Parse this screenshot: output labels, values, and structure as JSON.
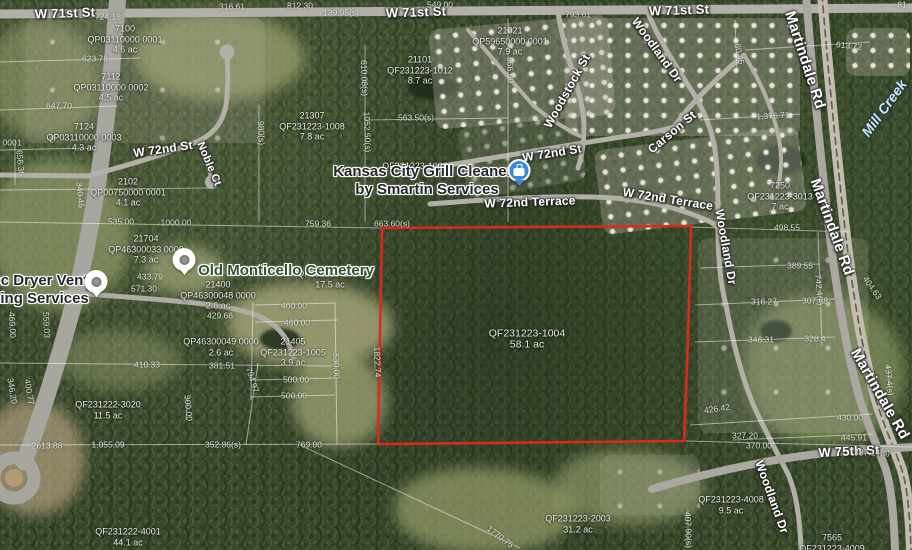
{
  "selected_parcel": {
    "id": "QF231223-1004",
    "area": "58.1 ac",
    "outline_color": "#dd2a1b"
  },
  "streets": [
    {
      "text": "W 71st St",
      "x": 65,
      "y": 13,
      "rot": -2,
      "size": 13
    },
    {
      "text": "W 71st St",
      "x": 416,
      "y": 12,
      "rot": -2,
      "size": 13
    },
    {
      "text": "W 71st St",
      "x": 679,
      "y": 10,
      "rot": -2,
      "size": 13
    },
    {
      "text": "W 72nd St",
      "x": 163,
      "y": 149,
      "rot": -8,
      "size": 12
    },
    {
      "text": "W 72nd St",
      "x": 552,
      "y": 153,
      "rot": -9,
      "size": 12
    },
    {
      "text": "W 72nd Terrace",
      "x": 530,
      "y": 202,
      "rot": -2,
      "size": 12
    },
    {
      "text": "W 72nd Terrace",
      "x": 668,
      "y": 199,
      "rot": 9,
      "size": 12
    },
    {
      "text": "Noble Ct",
      "x": 209,
      "y": 164,
      "rot": 67,
      "size": 11
    },
    {
      "text": "Woodstock St",
      "x": 567,
      "y": 91,
      "rot": -61,
      "size": 12
    },
    {
      "text": "Carson St",
      "x": 672,
      "y": 132,
      "rot": -40,
      "size": 12
    },
    {
      "text": "Woodland Dr",
      "x": 657,
      "y": 50,
      "rot": 54,
      "size": 12
    },
    {
      "text": "Woodland Dr",
      "x": 726,
      "y": 247,
      "rot": 80,
      "size": 12
    },
    {
      "text": "Woodland Dr",
      "x": 772,
      "y": 497,
      "rot": 70,
      "size": 12
    },
    {
      "text": "Martindale Rd",
      "x": 805,
      "y": 60,
      "rot": 72,
      "size": 15
    },
    {
      "text": "Martindale Rd",
      "x": 832,
      "y": 227,
      "rot": 70,
      "size": 15
    },
    {
      "text": "Martindale Rd",
      "x": 880,
      "y": 394,
      "rot": 60,
      "size": 15
    },
    {
      "text": "W 75th St",
      "x": 849,
      "y": 451,
      "rot": -3,
      "size": 13
    }
  ],
  "water_labels": [
    {
      "text": "Mill Creek",
      "x": 884,
      "y": 108,
      "rot": -54,
      "size": 14
    }
  ],
  "pois": [
    {
      "name": "kansas-city-grill-cleaners",
      "lines": [
        "Kansas City Grill Cleaners",
        "by Smartin Services"
      ],
      "x": 427,
      "y": 181,
      "color": "#23282d",
      "pin": "business",
      "icon": "briefcase-icon",
      "pin_x": 519,
      "pin_y": 175
    },
    {
      "name": "old-monticello-cemetery",
      "lines": [
        "Old Monticello Cemetery"
      ],
      "x": 286,
      "y": 271,
      "color": "#2f5233",
      "pin": "generic",
      "icon": "cemetery-icon",
      "pin_x": 184,
      "pin_y": 264
    },
    {
      "name": "dryer-vent-cleaning-services",
      "lines": [
        "oc Dryer Vent",
        "ning Services"
      ],
      "x": 40,
      "y": 290,
      "color": "#23282d",
      "pin": "generic",
      "icon": "services-icon",
      "pin_x": 96,
      "pin_y": 286
    }
  ],
  "parcel_labels": [
    {
      "lines": [
        "7100",
        "QP03110000 0001",
        "4.6 ac"
      ],
      "x": 125,
      "y": 39
    },
    {
      "lines": [
        "7112",
        "QP03110000 0002",
        "4.5 ac"
      ],
      "x": 111,
      "y": 87
    },
    {
      "lines": [
        "7124",
        "QP03110000 0003",
        "4.3 ac"
      ],
      "x": 84,
      "y": 137
    },
    {
      "lines": [
        "21021",
        "QP59650000 0001",
        "7.9 ac"
      ],
      "x": 510,
      "y": 41
    },
    {
      "lines": [
        "21101",
        "QF231223-1012",
        "8.7 ac"
      ],
      "x": 420,
      "y": 70
    },
    {
      "lines": [
        "21307",
        "QF231223-1008",
        "7.8 ac"
      ],
      "x": 312,
      "y": 126
    },
    {
      "lines": [
        "QF231223-1003"
      ],
      "x": 415,
      "y": 166
    },
    {
      "lines": [
        "2102",
        "QP00750000 0001",
        "4.1 ac"
      ],
      "x": 128,
      "y": 192
    },
    {
      "lines": [
        "21704",
        "QP46300033 0000",
        "7.3 ac"
      ],
      "x": 146,
      "y": 249
    },
    {
      "lines": [
        "21400",
        "QP46300048 0000",
        "2.6 ac"
      ],
      "x": 218,
      "y": 295
    },
    {
      "lines": [
        "QP46300049 0000",
        "2.6 ac"
      ],
      "x": 221,
      "y": 347
    },
    {
      "lines": [
        "21405",
        "QF231223-1005",
        "3.9 ac"
      ],
      "x": 293,
      "y": 352
    },
    {
      "lines": [
        "QF231223-1017",
        "17.5 ac"
      ],
      "x": 330,
      "y": 279
    },
    {
      "lines": [
        "QF231223-1004",
        "58.1 ac"
      ],
      "x": 527,
      "y": 339,
      "size": 10.5
    },
    {
      "lines": [
        "7250",
        "QF231223-3013",
        "7 ac"
      ],
      "x": 780,
      "y": 196
    },
    {
      "lines": [
        "QF231222-3020",
        "11.5 ac"
      ],
      "x": 108,
      "y": 410
    },
    {
      "lines": [
        "QF231222-4001",
        "44.1 ac"
      ],
      "x": 128,
      "y": 537
    },
    {
      "lines": [
        "QF231223-2003",
        "31.2 ac"
      ],
      "x": 578,
      "y": 524
    },
    {
      "lines": [
        "QF231223-4008",
        "9.5 ac"
      ],
      "x": 731,
      "y": 505
    },
    {
      "lines": [
        "7565",
        "QF231223-4009"
      ],
      "x": 832,
      "y": 543
    }
  ],
  "measurements": [
    {
      "t": "724.18",
      "x": 108,
      "y": 17
    },
    {
      "t": "316.61",
      "x": 232,
      "y": 7
    },
    {
      "t": "812.30",
      "x": 300,
      "y": 6
    },
    {
      "t": "139.95(s)",
      "x": 341,
      "y": 13
    },
    {
      "t": "549.00",
      "x": 440,
      "y": 5
    },
    {
      "t": "793.61",
      "x": 578,
      "y": 15
    },
    {
      "t": "81",
      "x": 902,
      "y": 5
    },
    {
      "t": "623.78",
      "x": 95,
      "y": 59
    },
    {
      "t": "647.70",
      "x": 59,
      "y": 106
    },
    {
      "t": "656.36",
      "x": 20,
      "y": 163,
      "rot": 85
    },
    {
      "t": "0001",
      "x": 12,
      "y": 143
    },
    {
      "t": "980(s)",
      "x": 261,
      "y": 133,
      "rot": 87
    },
    {
      "t": "610.08(s)",
      "x": 364,
      "y": 78,
      "rot": 88
    },
    {
      "t": "1052.50(s)",
      "x": 367,
      "y": 132,
      "rot": 88
    },
    {
      "t": "666.60",
      "x": 510,
      "y": 70,
      "rot": 88
    },
    {
      "t": "563.50(s)",
      "x": 416,
      "y": 118
    },
    {
      "t": "80.45",
      "x": 739,
      "y": 54,
      "rot": 78
    },
    {
      "t": "613.72",
      "x": 849,
      "y": 46,
      "rot": 6
    },
    {
      "t": "1,376.71",
      "x": 773,
      "y": 116,
      "rot": -3
    },
    {
      "t": "340.45",
      "x": 80,
      "y": 195,
      "rot": 85
    },
    {
      "t": "535.00",
      "x": 121,
      "y": 222
    },
    {
      "t": "1000.00",
      "x": 176,
      "y": 223
    },
    {
      "t": "759.36",
      "x": 318,
      "y": 224
    },
    {
      "t": "663.60(s)",
      "x": 392,
      "y": 224
    },
    {
      "t": "498.55",
      "x": 787,
      "y": 228
    },
    {
      "t": "433.79",
      "x": 150,
      "y": 277
    },
    {
      "t": "571.30",
      "x": 144,
      "y": 289
    },
    {
      "t": "429.66",
      "x": 220,
      "y": 316
    },
    {
      "t": "469.00",
      "x": 12,
      "y": 325,
      "rot": 87
    },
    {
      "t": "559.03",
      "x": 46,
      "y": 325,
      "rot": 87
    },
    {
      "t": "460.00",
      "x": 294,
      "y": 306
    },
    {
      "t": "460.00",
      "x": 297,
      "y": 323
    },
    {
      "t": "389.55",
      "x": 800,
      "y": 266
    },
    {
      "t": "742.4(s)",
      "x": 819,
      "y": 290,
      "rot": 85
    },
    {
      "t": "404.63",
      "x": 872,
      "y": 288,
      "rot": 55
    },
    {
      "t": "316.27",
      "x": 764,
      "y": 302
    },
    {
      "t": "307.68",
      "x": 815,
      "y": 301
    },
    {
      "t": "346.31",
      "x": 761,
      "y": 340
    },
    {
      "t": "328.4",
      "x": 815,
      "y": 339
    },
    {
      "t": "530.00",
      "x": 336,
      "y": 366,
      "rot": 88
    },
    {
      "t": "1822.74",
      "x": 377,
      "y": 362,
      "rot": 88
    },
    {
      "t": "500.00",
      "x": 296,
      "y": 380
    },
    {
      "t": "500.00",
      "x": 294,
      "y": 396
    },
    {
      "t": "410.33",
      "x": 147,
      "y": 365
    },
    {
      "t": "381.51",
      "x": 222,
      "y": 366
    },
    {
      "t": "346.20",
      "x": 12,
      "y": 391,
      "rot": 80
    },
    {
      "t": "400.77",
      "x": 29,
      "y": 392,
      "rot": 80
    },
    {
      "t": "794.97",
      "x": 252,
      "y": 380,
      "rot": 72
    },
    {
      "t": "300.00",
      "x": 188,
      "y": 408,
      "rot": 85
    },
    {
      "t": "2613.88",
      "x": 47,
      "y": 446
    },
    {
      "t": "1,055.09",
      "x": 108,
      "y": 445
    },
    {
      "t": "352.86(s)",
      "x": 223,
      "y": 445
    },
    {
      "t": "769.00",
      "x": 309,
      "y": 445
    },
    {
      "t": "426.42",
      "x": 717,
      "y": 409,
      "rot": -8
    },
    {
      "t": "430.00",
      "x": 850,
      "y": 418
    },
    {
      "t": "327.20",
      "x": 745,
      "y": 436
    },
    {
      "t": "445.91",
      "x": 854,
      "y": 438
    },
    {
      "t": "370.00",
      "x": 759,
      "y": 446
    },
    {
      "t": "387.14(s)",
      "x": 872,
      "y": 453
    },
    {
      "t": "437.4(s)",
      "x": 889,
      "y": 380,
      "rot": 85
    },
    {
      "t": "1770.75",
      "x": 500,
      "y": 537,
      "rot": 37
    },
    {
      "t": "407.90(s)",
      "x": 688,
      "y": 530,
      "rot": 88
    }
  ]
}
